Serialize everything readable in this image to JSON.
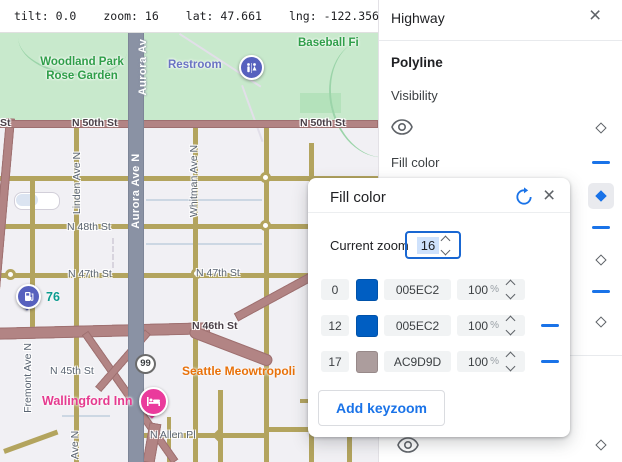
{
  "topbar": {
    "readouts": [
      {
        "label": "tilt:",
        "value": "0.0"
      },
      {
        "label": "zoom:",
        "value": "16"
      },
      {
        "label": "lat:",
        "value": "47.661"
      },
      {
        "label": "lng:",
        "value": "-122.356"
      }
    ]
  },
  "panel": {
    "title": "Highway",
    "close_icon": "×",
    "sections": {
      "polyline": "Polyline",
      "visibility": "Visibility",
      "fill_color": "Fill color"
    }
  },
  "dialog": {
    "title": "Fill color",
    "close_icon": "×",
    "current_zoom_label": "Current zoom",
    "current_zoom_value": "16",
    "rows": [
      {
        "zoom": "0",
        "hex": "005EC2",
        "swatch_style": "background:#005ec2",
        "opacity": "100",
        "percent": "%"
      },
      {
        "zoom": "12",
        "hex": "005EC2",
        "swatch_style": "background:#005ec2",
        "opacity": "100",
        "percent": "%"
      },
      {
        "zoom": "17",
        "hex": "AC9D9D",
        "swatch_style": "background:#ac9d9d",
        "opacity": "100",
        "percent": "%"
      }
    ],
    "add_button": "Add keyzoom"
  },
  "colors": {
    "accent": "#1a73e8",
    "keyzoom_blue": "#005EC2",
    "keyzoom_mauve": "#AC9D9D",
    "highway_fill_at_z16": "#8a92a4"
  },
  "map": {
    "labels": {
      "park": "Woodland Park Rose Garden",
      "baseball": "Baseball Fi",
      "restroom": "Restroom",
      "st_partial": "St",
      "n50_center": "N 50th St",
      "n50_right": "N 50th St",
      "linden": "Linden Ave N",
      "whitman": "Whitman Ave N",
      "aurora_top": "Aurora Av",
      "aurora": "Aurora Ave N",
      "n48": "N 48th St",
      "n47_left": "N 47th St",
      "n47_right": "N 47th St",
      "n46": "N 46th St",
      "n45": "N 45th St",
      "fremont": "Fremont Ave N",
      "ave_n": "Ave N",
      "n_allen": "N Allen Pl",
      "meowtropolis": "Seattle Meowtropoli",
      "wallingford": "Wallingford Inn",
      "seventy_six": "76",
      "route_99": "99"
    }
  }
}
